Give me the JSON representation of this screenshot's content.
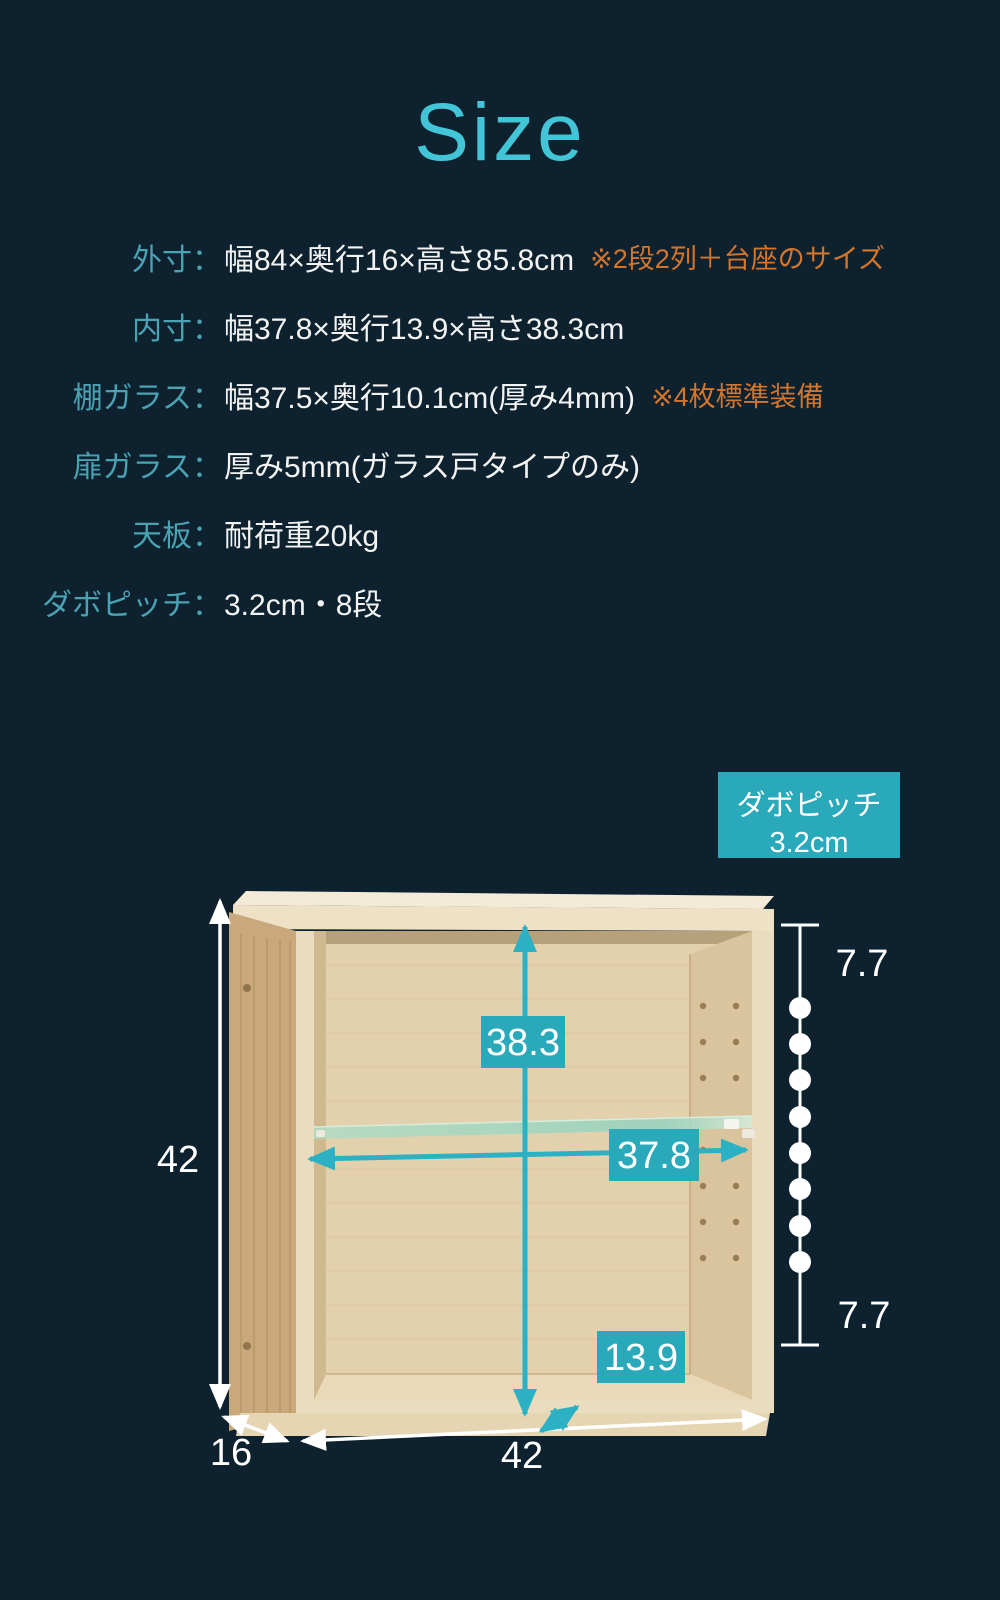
{
  "title": {
    "text": "Size"
  },
  "specs": {
    "rows": [
      {
        "label": "外寸：",
        "value": "幅84×奥行16×高さ85.8cm",
        "note": "※2段2列＋台座のサイズ"
      },
      {
        "label": "内寸：",
        "value": "幅37.8×奥行13.9×高さ38.3cm",
        "note": ""
      },
      {
        "label": "棚ガラス：",
        "value": "幅37.5×奥行10.1cm(厚み4mm)",
        "note": "※4枚標準装備"
      },
      {
        "label": "扉ガラス：",
        "value": "厚み5mm(ガラス戸タイプのみ)",
        "note": ""
      },
      {
        "label": "天板：",
        "value": "耐荷重20kg",
        "note": ""
      },
      {
        "label": "ダボピッチ：",
        "value": "3.2cm・8段",
        "note": ""
      }
    ]
  },
  "diagram": {
    "callout": {
      "line1": "ダボピッチ",
      "line2": "3.2cm"
    },
    "outer_height": "42",
    "outer_depth": "16",
    "outer_width": "42",
    "inner_height": "38.3",
    "inner_width": "37.8",
    "inner_depth": "13.9",
    "pitch_top": "7.7",
    "pitch_bottom": "7.7",
    "dowel_dot_count": 8
  },
  "colors": {
    "background": "#0d212f",
    "title_cyan": "#41c5d7",
    "label_teal": "#4aa3b3",
    "value_white": "#f2f3f2",
    "note_orange": "#d4752c",
    "badge_teal": "#29a9ba",
    "arrow_cyan": "#2bb1c3",
    "measure_white": "#ffffff"
  }
}
